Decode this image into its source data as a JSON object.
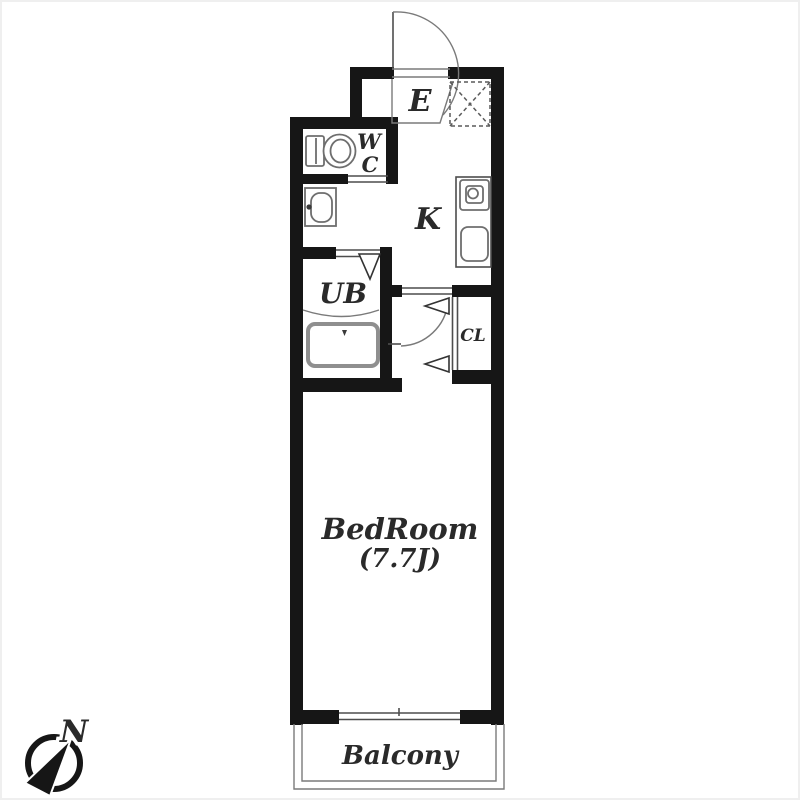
{
  "floorplan": {
    "rooms": {
      "entrance": {
        "label": "E"
      },
      "toilet": {
        "label_top": "W",
        "label_bottom": "C"
      },
      "kitchen": {
        "label": "K"
      },
      "bath": {
        "label": "UB"
      },
      "closet": {
        "label": "CL"
      },
      "bedroom": {
        "label": "BedRoom",
        "size": "(7.7J)"
      },
      "balcony": {
        "label": "Balcony"
      }
    },
    "compass": {
      "north_label": "N"
    },
    "fixtures": [
      "toilet-icon",
      "washbasin-icon",
      "bathtub-icon",
      "stove-icon",
      "kitchen-sink-icon",
      "shoe-cabinet-icon",
      "entrance-door-swing-icon",
      "bedroom-door-swing-icon",
      "window-icon",
      "compass-icon"
    ],
    "colors": {
      "wall": "#161616",
      "line": "#4d4d4d",
      "fixture": "#6e6e6e",
      "background": "#ffffff"
    }
  }
}
